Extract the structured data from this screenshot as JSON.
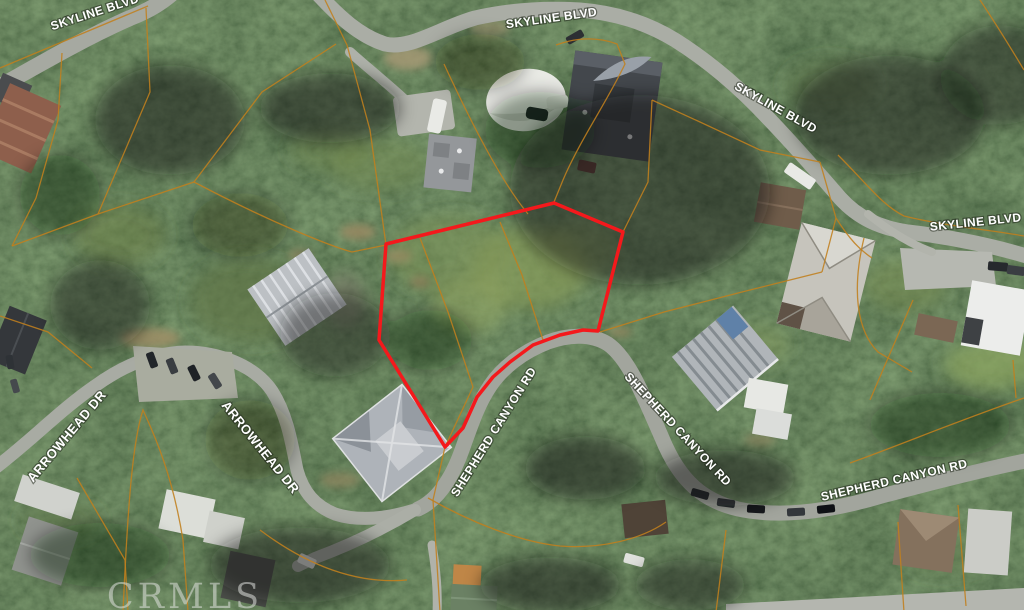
{
  "map": {
    "description": "Aerial parcel map with highlighted lot outlined in red",
    "watermark": "CRMLS",
    "colors": {
      "selected_outline": "#f4191c",
      "parcel_lines": "#c07f1e",
      "street_label": "#ffffff"
    },
    "street_labels": [
      {
        "id": "skyline-blvd-1",
        "text": "SKYLINE BLVD"
      },
      {
        "id": "skyline-blvd-2",
        "text": "SKYLINE BLVD"
      },
      {
        "id": "skyline-blvd-3",
        "text": "SKYLINE BLVD"
      },
      {
        "id": "skyline-blvd-4",
        "text": "SKYLINE BLVD"
      },
      {
        "id": "arrowhead-dr-1",
        "text": "ARROWHEAD DR"
      },
      {
        "id": "arrowhead-dr-2",
        "text": "ARROWHEAD DR"
      },
      {
        "id": "shepherd-canyon-rd-1",
        "text": "SHEPHERD CANYON RD"
      },
      {
        "id": "shepherd-canyon-rd-2",
        "text": "SHEPHERD CANYON RD"
      },
      {
        "id": "shepherd-canyon-rd-3",
        "text": "SHEPHERD CANYON RD"
      }
    ],
    "selected_parcel": {
      "vertices_px": [
        [
          386,
          244
        ],
        [
          554,
          203
        ],
        [
          623,
          232
        ],
        [
          598,
          331
        ],
        [
          583,
          330
        ],
        [
          560,
          335
        ],
        [
          533,
          345
        ],
        [
          510,
          362
        ],
        [
          493,
          377
        ],
        [
          477,
          397
        ],
        [
          463,
          428
        ],
        [
          445,
          447
        ],
        [
          379,
          340
        ]
      ]
    }
  }
}
